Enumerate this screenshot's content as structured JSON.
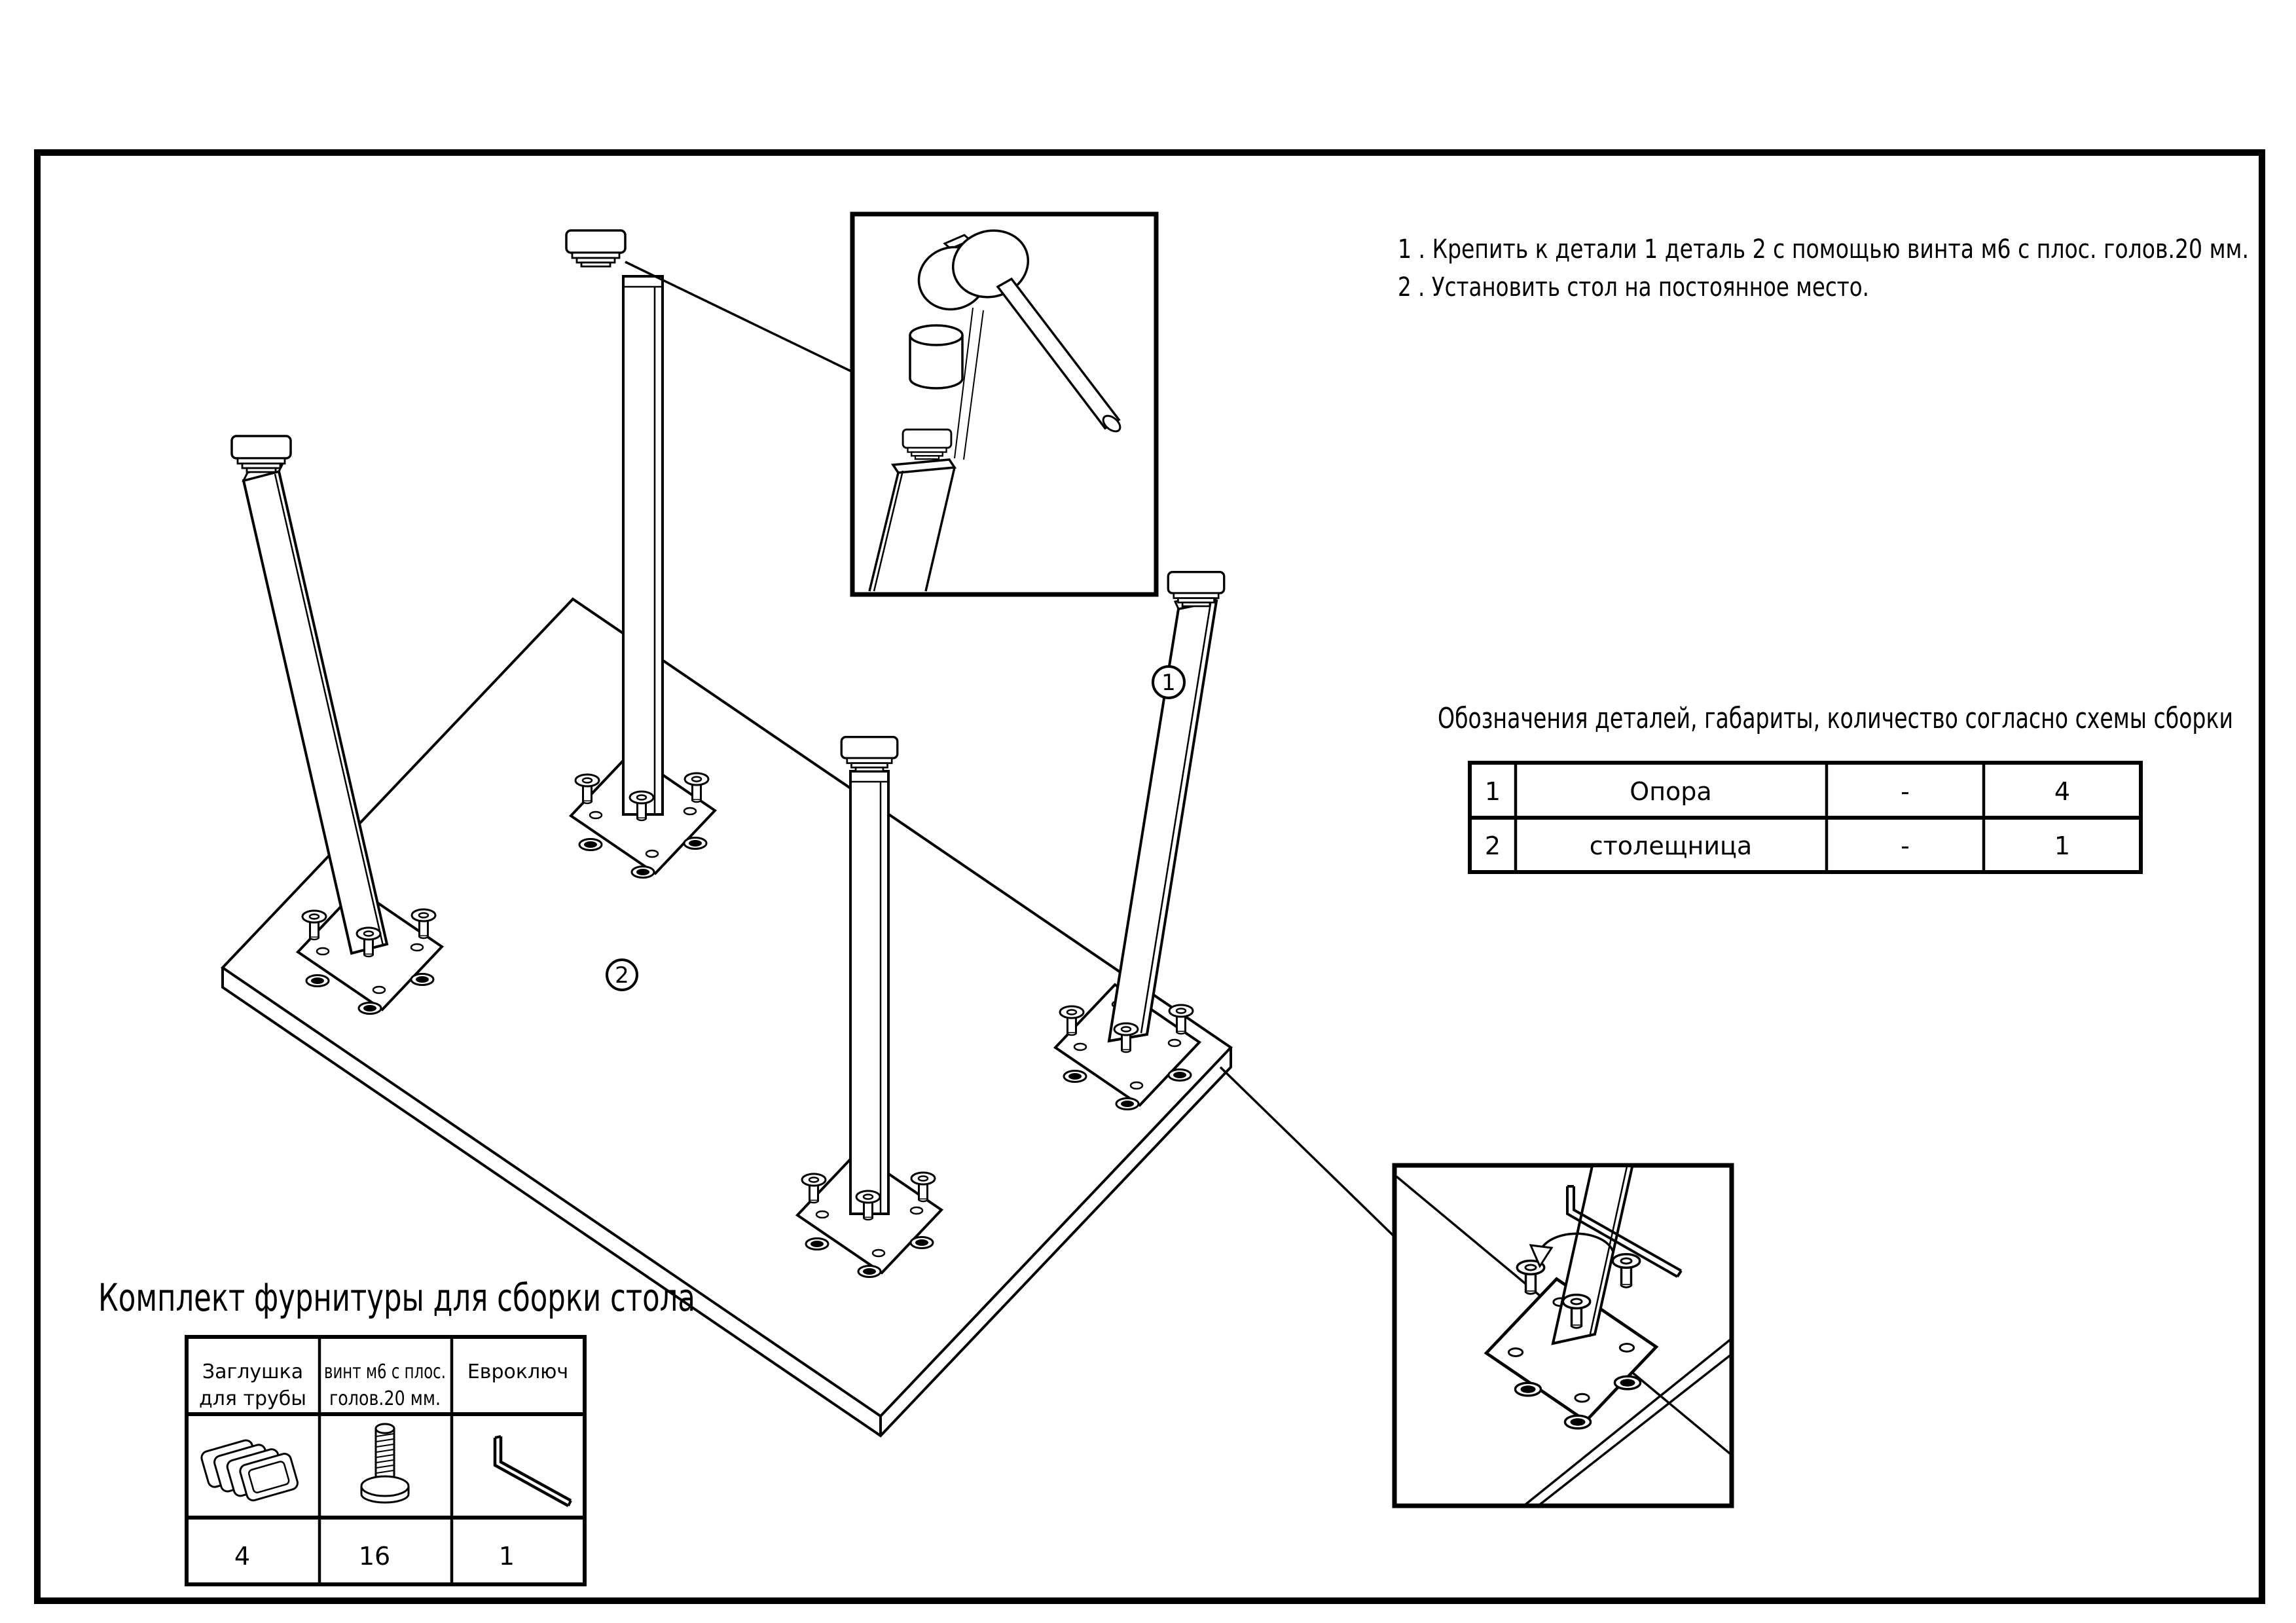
{
  "instructions": {
    "line1": "1 . Крепить к детали 1 деталь 2 с помощью винта м6 с плос. голов.20 мм.",
    "line2": "2 . Установить стол на постоянное место."
  },
  "part_labels": {
    "leg": "1",
    "tabletop": "2"
  },
  "parts_table": {
    "title": "Обозначения деталей, габариты, количество согласно схемы сборки",
    "rows": [
      {
        "num": "1",
        "name": "Опора",
        "dimensions": "-",
        "qty": "4"
      },
      {
        "num": "2",
        "name": "столещница",
        "dimensions": "-",
        "qty": "1"
      }
    ]
  },
  "hardware_kit": {
    "title": "Комплект фурнитуры для сборки стола",
    "columns": [
      {
        "name_line1": "Заглушка",
        "name_line2": "для трубы",
        "qty": "4"
      },
      {
        "name_line1": "винт м6 с плос.",
        "name_line2": "голов.20 мм.",
        "qty": "16"
      },
      {
        "name_line1": "Евроключ",
        "name_line2": "",
        "qty": "1"
      }
    ]
  },
  "icons": {
    "hardware_col1": "tube-plug-icon",
    "hardware_col2": "flat-head-screw-icon",
    "hardware_col3": "hex-key-icon",
    "callout_top": "mallet-icon",
    "callout_bottom": "rotation-arrow-icon"
  },
  "colors": {
    "line": "#000000",
    "background": "#ffffff"
  }
}
